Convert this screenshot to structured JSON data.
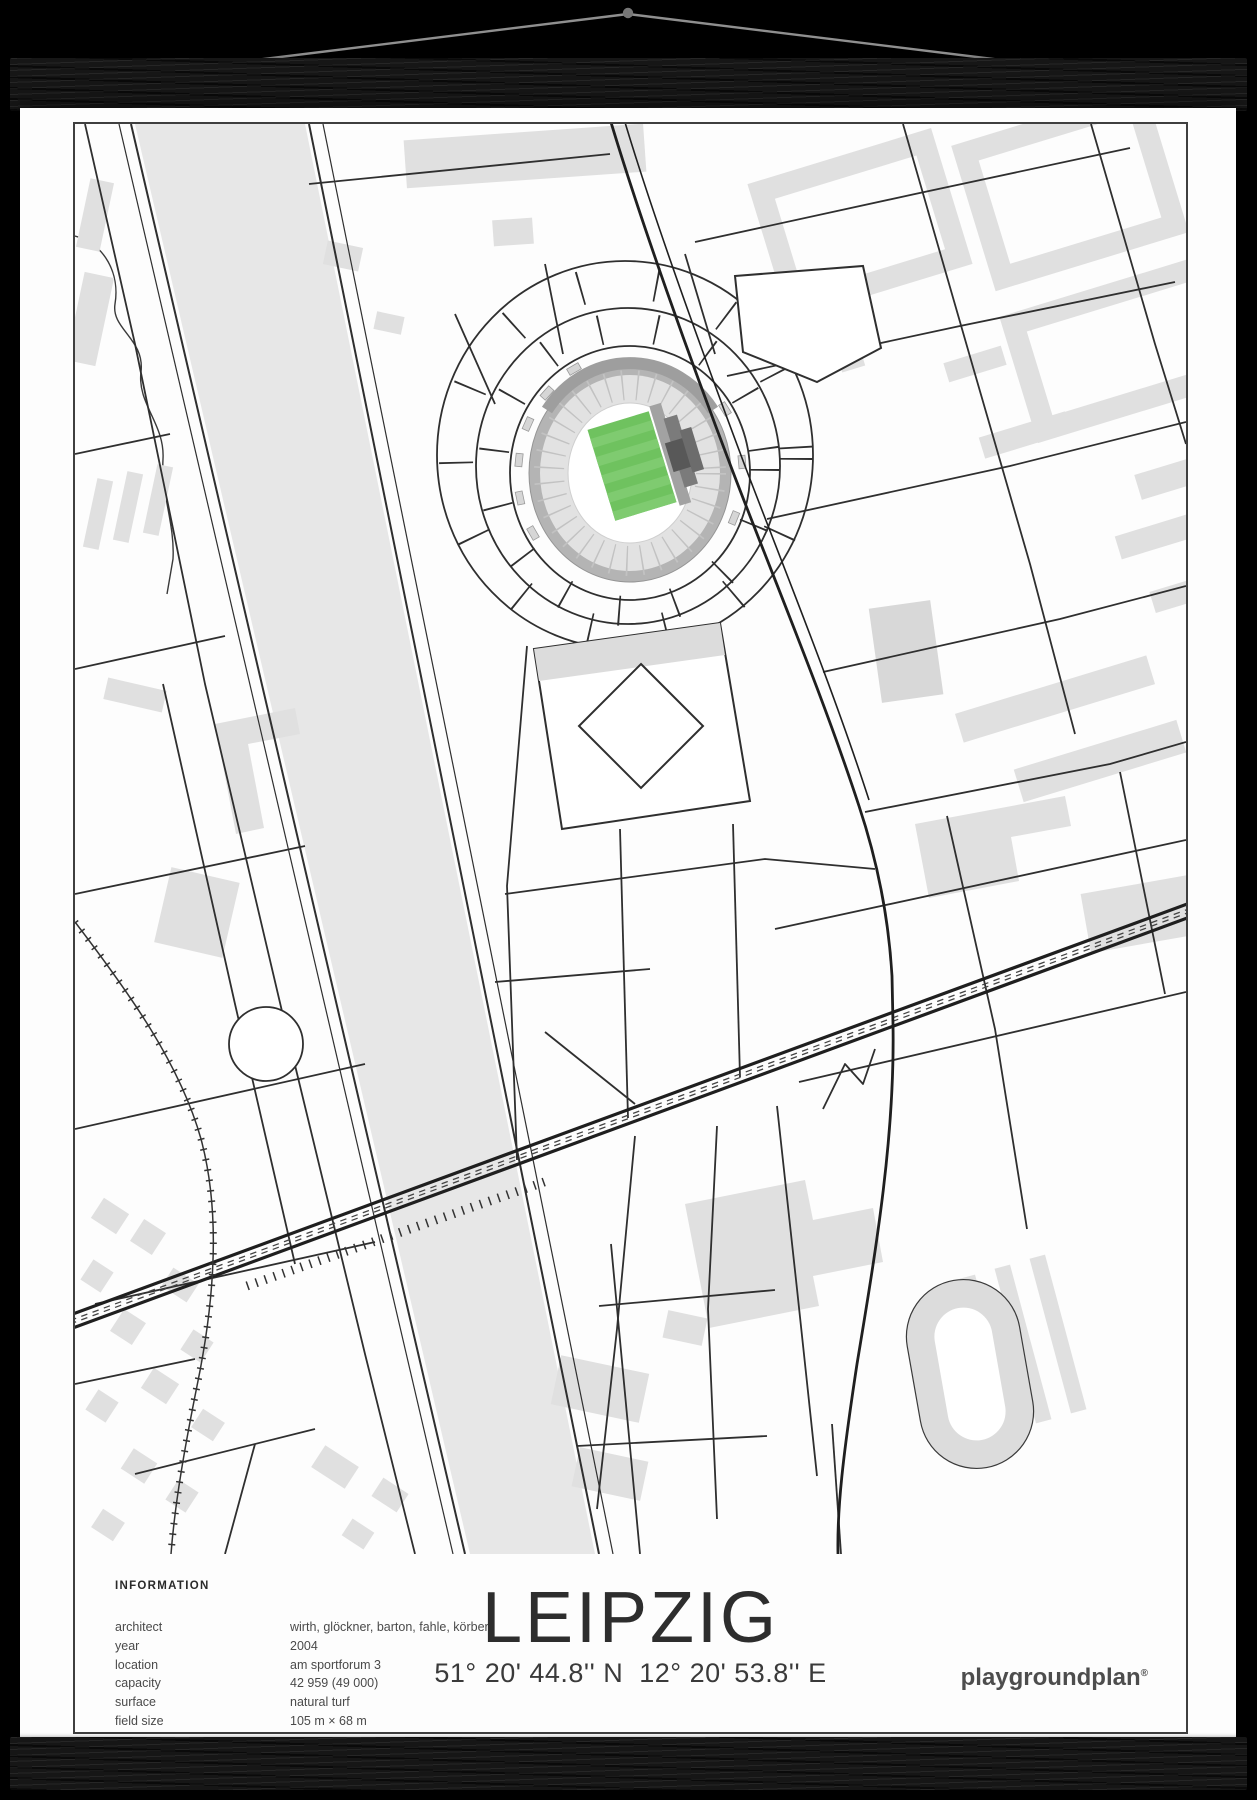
{
  "poster": {
    "title": "LEIPZIG",
    "coordinates": "51° 20' 44.8'' N  12° 20' 53.8'' E",
    "brand": "playgroundplan",
    "brand_mark": "®",
    "information": {
      "heading": "INFORMATION",
      "rows": [
        {
          "label": "architect",
          "value": "wirth, glöckner, barton, fahle, körber"
        },
        {
          "label": "year",
          "value": "2004"
        },
        {
          "label": "location",
          "value": "am sportforum 3"
        },
        {
          "label": "capacity",
          "value": "42 959 (49 000)"
        },
        {
          "label": "surface",
          "value": "natural turf"
        },
        {
          "label": "field size",
          "value": "105 m × 68 m"
        }
      ]
    },
    "colors": {
      "pitch_green": "#6fc25f",
      "pitch_stripe": "#7fcb70",
      "building_gray": "#e0e0e0",
      "river_gray": "#e7e7e7",
      "street_line": "#2f2f2f",
      "main_road": "#1f1f1f",
      "stand_gray": "#e2e2e2",
      "bowl_rim_gray": "#b4b4b4",
      "wood_black": "#161616",
      "string_gray": "#8f8f8f"
    }
  }
}
